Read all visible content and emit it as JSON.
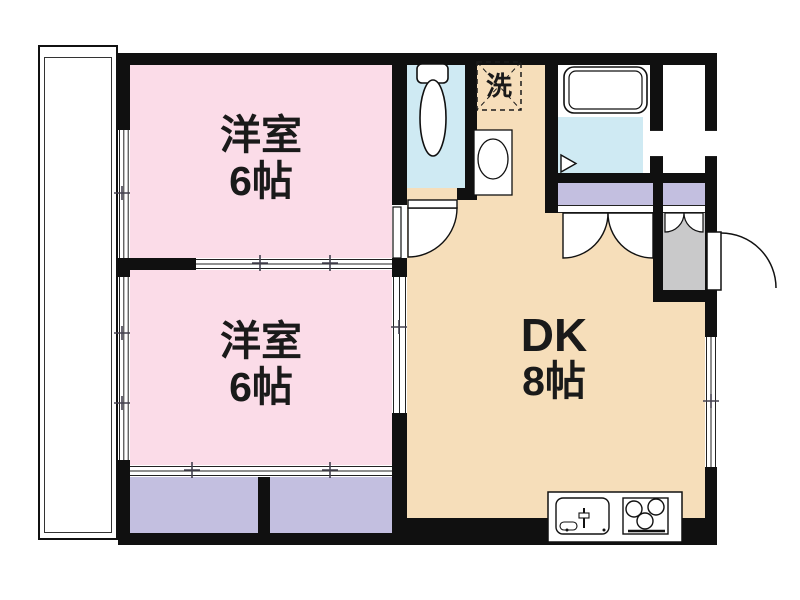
{
  "rooms": {
    "western_room_1": {
      "name": "洋室",
      "size": "6帖"
    },
    "western_room_2": {
      "name": "洋室",
      "size": "6帖"
    },
    "dining_kitchen": {
      "name": "DK",
      "size": "8帖"
    },
    "laundry_space": {
      "label": "洗"
    }
  },
  "colors": {
    "room_pink": "#FBDCE8",
    "dk_tan": "#F6DEBA",
    "closet_purple": "#C3BFE0",
    "bath_cyan": "#CFEAF3",
    "entry_gray": "#C9C9CA",
    "wall_black": "#101010"
  },
  "fixtures": {
    "toilet": "toilet-icon",
    "washbasin": "washbasin-icon",
    "washing_machine_area": "washing-machine-dashed-box",
    "bathtub": "bathtub-icon",
    "kitchen_sink": "kitchen-sink-icon",
    "stove": "stove-icon",
    "entrance_door": "entrance-door-arc",
    "balcony": "balcony"
  }
}
